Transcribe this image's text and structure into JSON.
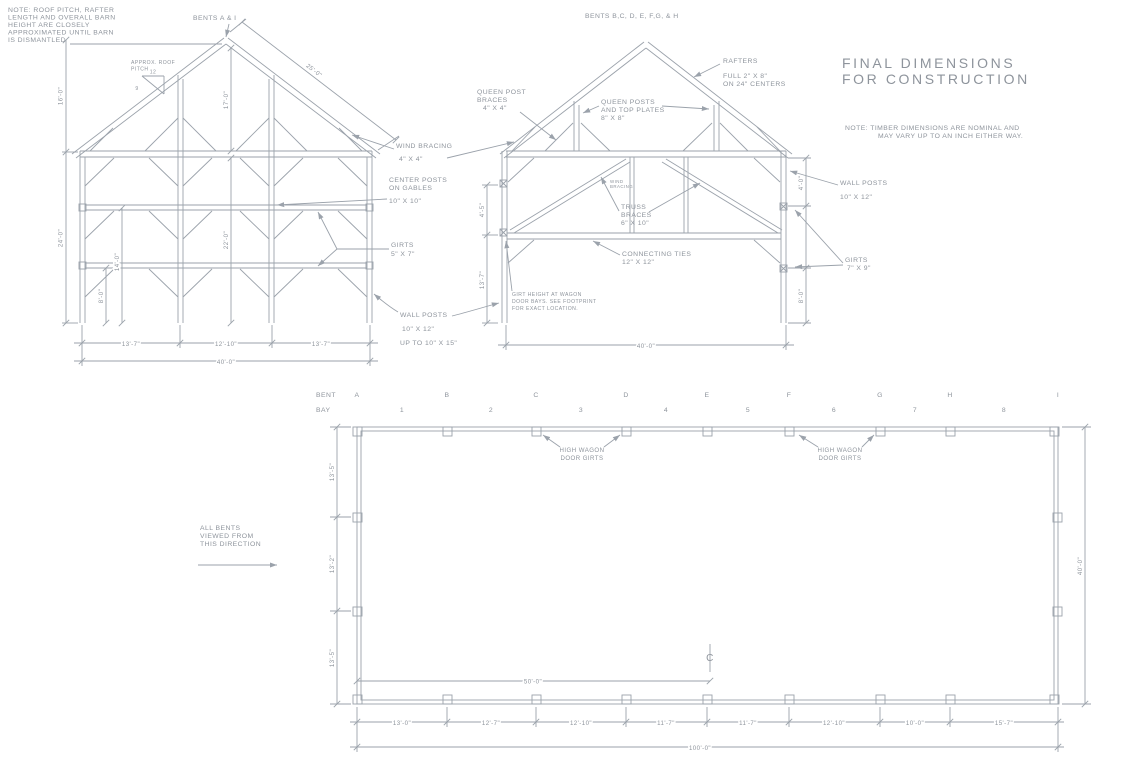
{
  "title": {
    "line1": "FINAL DIMENSIONS",
    "line2": "FOR CONSTRUCTION"
  },
  "notes": {
    "top_left": [
      "NOTE: ROOF PITCH, RAFTER",
      "LENGTH AND OVERALL BARN",
      "HEIGHT ARE CLOSELY",
      "APPROXIMATED UNTIL BARN",
      "IS DISMANTLED"
    ],
    "right_1": "NOTE:  TIMBER DIMENSIONS ARE NOMINAL AND",
    "right_2": "MAY VARY UP TO AN INCH EITHER WAY."
  },
  "gable_bent": {
    "heading": "BENTS A & I",
    "pitch": {
      "label1": "APPROX. ROOF",
      "label2": "PITCH",
      "run": "12",
      "rise": "9"
    },
    "dims": {
      "rafter": "25'-0\"",
      "ridge_height": "17'-0\"",
      "roof_height": "16'-0\"",
      "wall_height": "24'-0\"",
      "girt_upper": "14'-0\"",
      "interior": "22'-0\"",
      "girt_lower": "8'-0\"",
      "bay_left": "13'-7\"",
      "bay_center": "12'-10\"",
      "bay_right": "13'-7\"",
      "overall": "40'-0\""
    }
  },
  "interior_bent": {
    "heading": "BENTS B,C, D, E, F,G, & H",
    "dims": {
      "left_upper": "4'-5\"",
      "left_lower": "13'-7\"",
      "right_upper": "4'-0\"",
      "right_lower": "8'-0\"",
      "overall": "40'-0\""
    }
  },
  "callouts": {
    "wind_bracing": [
      "WIND BRACING",
      "4\" X 4\""
    ],
    "center_posts": [
      "CENTER POSTS",
      "ON GABLES",
      "10\" X 10\""
    ],
    "girts_gable": [
      "GIRTS",
      "5\" X 7\""
    ],
    "wall_posts_gable": [
      "WALL POSTS",
      "10\" X 12\"",
      "UP TO 10\" X 15\""
    ],
    "rafters": [
      "RAFTERS",
      "FULL 2\" X 8\"",
      "ON 24\" CENTERS"
    ],
    "queen_post_braces": [
      "QUEEN POST",
      "BRACES",
      "4\" X 4\""
    ],
    "queen_posts": [
      "QUEEN POSTS",
      "AND TOP PLATES",
      "8\" X 8\""
    ],
    "truss_braces": [
      "TRUSS",
      "BRACES",
      "6\" X 10\""
    ],
    "connecting_ties": [
      "CONNECTING TIES",
      "12\" X 12\""
    ],
    "wall_posts_interior": [
      "WALL POSTS",
      "10\" X 12\""
    ],
    "girts_interior": [
      "GIRTS",
      "7\" X 9\""
    ],
    "wind_bracing_small": [
      "WIND",
      "BRACING"
    ],
    "girt_height_note": [
      "GIRT HEIGHT AT WAGON",
      "DOOR BAYS.  SEE FOOTPRINT",
      "FOR EXACT LOCATION."
    ]
  },
  "footprint": {
    "bent_label": "BENT",
    "bay_label": "BAY",
    "bents": [
      "A",
      "B",
      "C",
      "D",
      "E",
      "F",
      "G",
      "H",
      "I"
    ],
    "bays": [
      "1",
      "2",
      "3",
      "4",
      "5",
      "6",
      "7",
      "8"
    ],
    "high_wagon_1": [
      "HIGH WAGON",
      "DOOR GIRTS"
    ],
    "high_wagon_2": [
      "HIGH WAGON",
      "DOOR GIRTS"
    ],
    "view_note": [
      "ALL BENTS",
      "VIEWED FROM",
      "THIS DIRECTION"
    ],
    "centerline_symbol": "C",
    "dims": {
      "left": [
        "13'-5\"",
        "13'-2\"",
        "13'-5\""
      ],
      "right": "40'-0\"",
      "half": "50'-0\"",
      "bays": [
        "13'-0\"",
        "12'-7\"",
        "12'-10\"",
        "11'-7\"",
        "11'-7\"",
        "12'-10\"",
        "10'-0\"",
        "15'-7\""
      ],
      "overall": "100'-0\""
    }
  },
  "colors": {
    "line": "#9ba2ab",
    "text": "#8e949c"
  }
}
